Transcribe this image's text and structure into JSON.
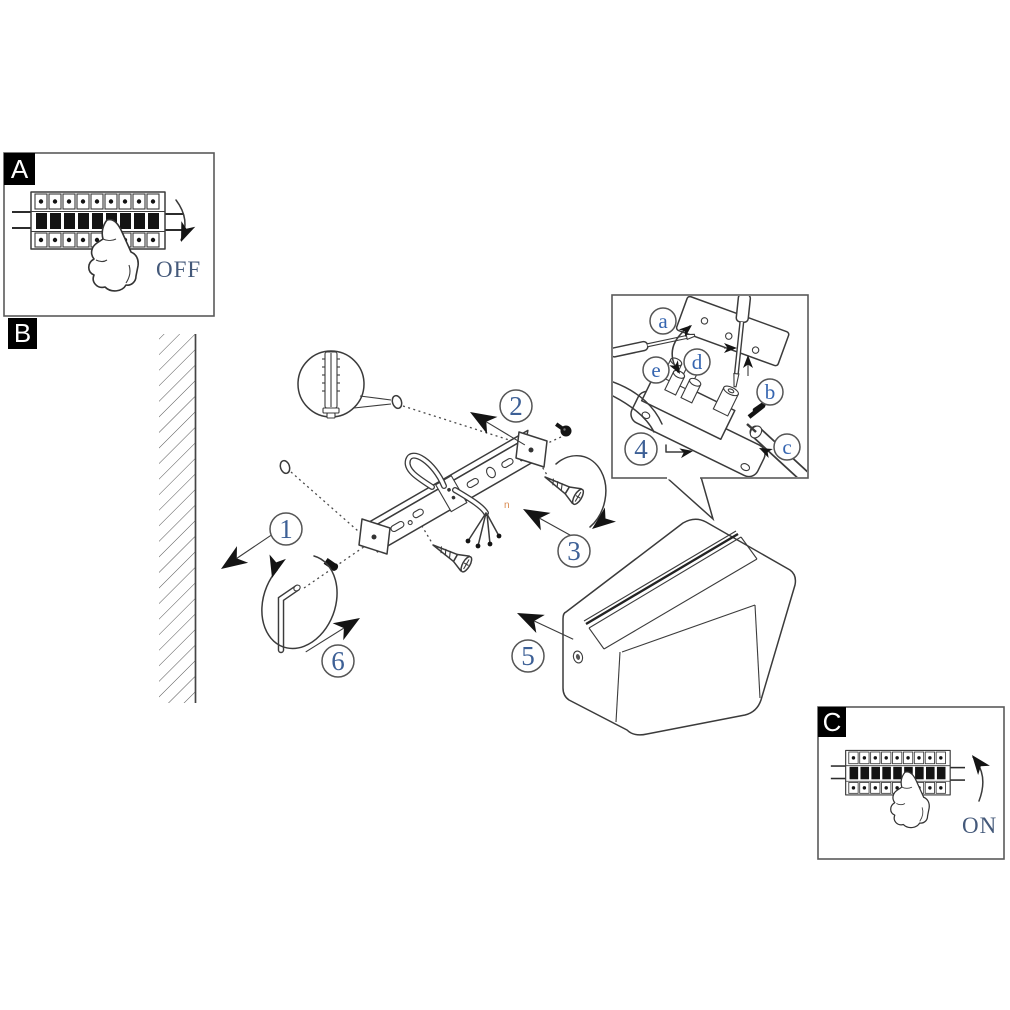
{
  "panel_a": {
    "label": "A",
    "status_text": "OFF"
  },
  "panel_b": {
    "label": "B"
  },
  "panel_c": {
    "label": "C",
    "status_text": "ON"
  },
  "steps": {
    "n1": "1",
    "n2": "2",
    "n3": "3",
    "n4": "4",
    "n5": "5",
    "n6": "6"
  },
  "callouts": {
    "a": "a",
    "b": "b",
    "c": "c",
    "d": "d",
    "e": "e"
  },
  "stray_mark": "n",
  "colors": {
    "line": "#3b3b3b",
    "panel_border": "#5a5a5a",
    "label_bg": "#000000",
    "label_text": "#ffffff",
    "number_blue": "#3d6096",
    "callout_blue": "#3565b0",
    "status_blue": "#44597a",
    "stray_orange": "#d98a4f",
    "solid_black": "#141414"
  }
}
